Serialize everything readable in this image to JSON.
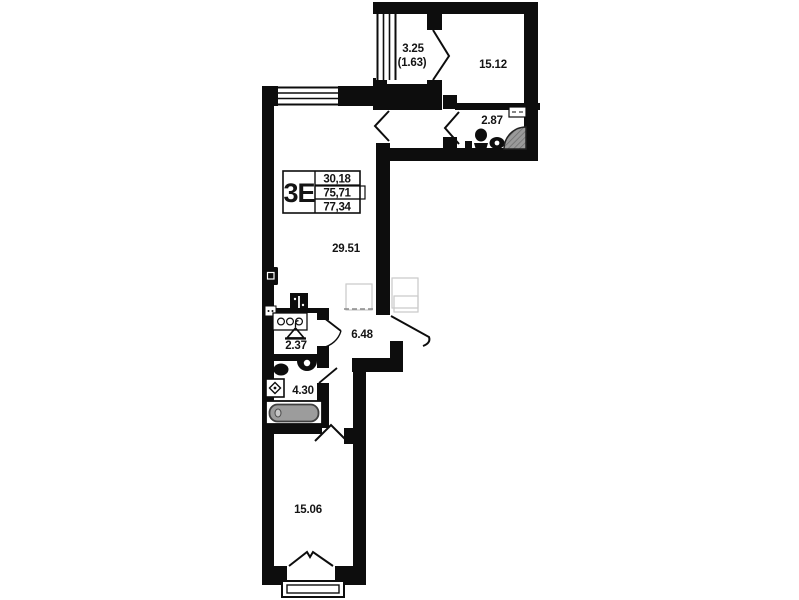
{
  "unit": {
    "type": "3E",
    "rows": [
      "30,18",
      "75,71",
      "77,34"
    ]
  },
  "rooms": {
    "balcony": {
      "area": "3.25",
      "reduced": "(1.63)"
    },
    "bedroom_top": {
      "area": "15.12"
    },
    "wc_top": {
      "area": "2.87"
    },
    "living_kitchen": {
      "area": "29.51"
    },
    "hallway": {
      "area": "6.48"
    },
    "wardrobe": {
      "area": "2.37"
    },
    "bathroom": {
      "area": "4.30"
    },
    "bedroom_bottom": {
      "area": "15.06"
    }
  },
  "icons": {
    "wardrobe_fixture": "hanger-icon",
    "kitchen_fixture": "stove-icon",
    "shaft": "vent-shaft-icon",
    "panel": "electrical-panel-icon",
    "bath_fixtures": [
      "toilet-icon",
      "sink-icon",
      "washing-machine-icon",
      "bathtub-icon"
    ],
    "wc_fixtures": [
      "toilet-icon",
      "sink-icon",
      "corner-shower-icon"
    ]
  },
  "colors": {
    "wall": "#0d0d0d",
    "tub": "#9c9c9c",
    "shower": "#9a9a9a",
    "faint": "#c9c9c9"
  }
}
